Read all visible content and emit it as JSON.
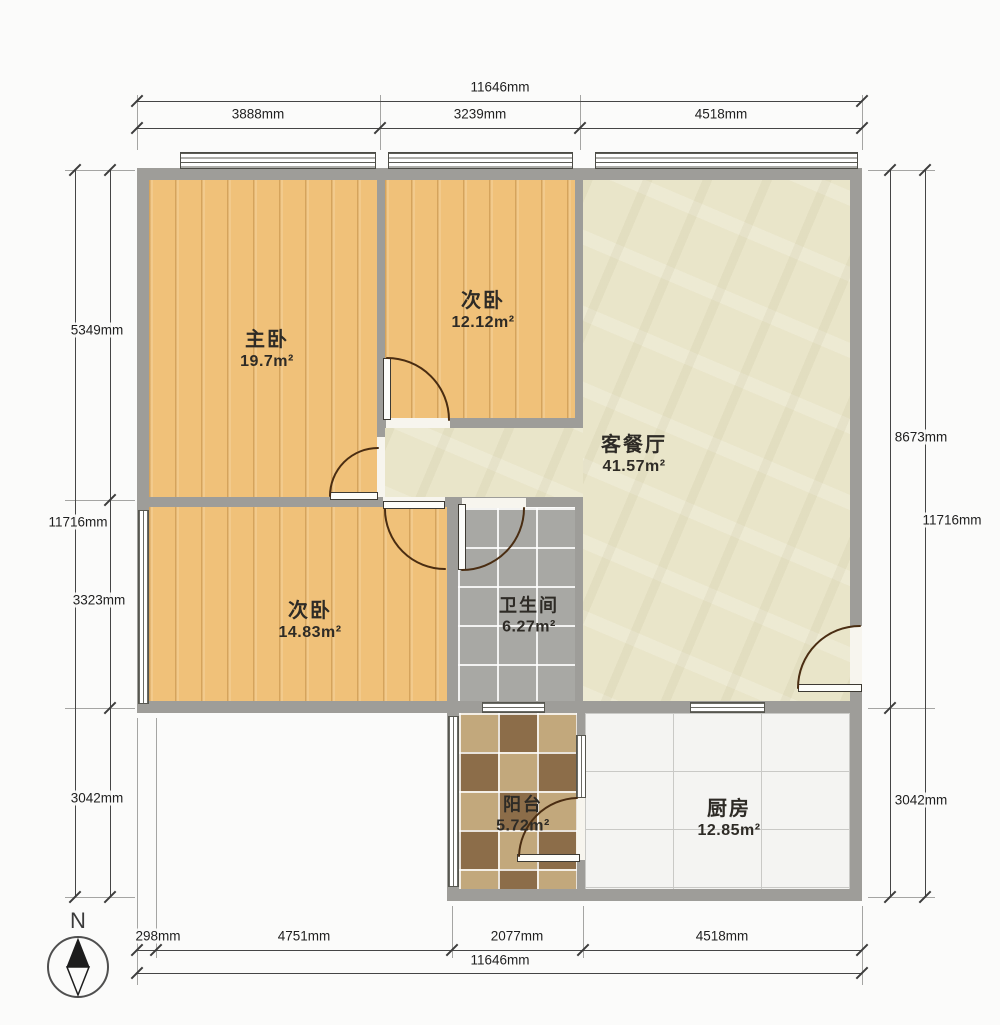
{
  "plan": {
    "rooms": {
      "master_bedroom": {
        "name": "主卧",
        "area": "19.7m²"
      },
      "bedroom2": {
        "name": "次卧",
        "area": "12.12m²"
      },
      "living_dining": {
        "name": "客餐厅",
        "area": "41.57m²"
      },
      "bedroom3": {
        "name": "次卧",
        "area": "14.83m²"
      },
      "bathroom": {
        "name": "卫生间",
        "area": "6.27m²"
      },
      "balcony": {
        "name": "阳台",
        "area": "5.72m²"
      },
      "kitchen": {
        "name": "厨房",
        "area": "12.85m²"
      }
    },
    "dimensions": {
      "top": {
        "total": "11646mm",
        "segments": [
          "3888mm",
          "3239mm",
          "4518mm"
        ]
      },
      "bottom": {
        "total": "11646mm",
        "segments": [
          "298mm",
          "4751mm",
          "2077mm",
          "4518mm"
        ]
      },
      "left": {
        "total": "11716mm",
        "segments": [
          "5349mm",
          "3323mm",
          "3042mm"
        ]
      },
      "right": {
        "total": "11716mm",
        "segments": [
          "8673mm",
          "3042mm"
        ]
      }
    },
    "compass": {
      "label": "N"
    },
    "colors": {
      "wall": "#9e9d99",
      "wood_floor": "#f0c179",
      "living_floor": "#e9e5c9",
      "bath_tile": "#a8a8a4",
      "balcony_tile_dark": "#8c6d49",
      "balcony_tile_light": "#c2a87c",
      "kitchen_tile": "#f4f4f2",
      "door_arc": "#4a2d12"
    }
  }
}
